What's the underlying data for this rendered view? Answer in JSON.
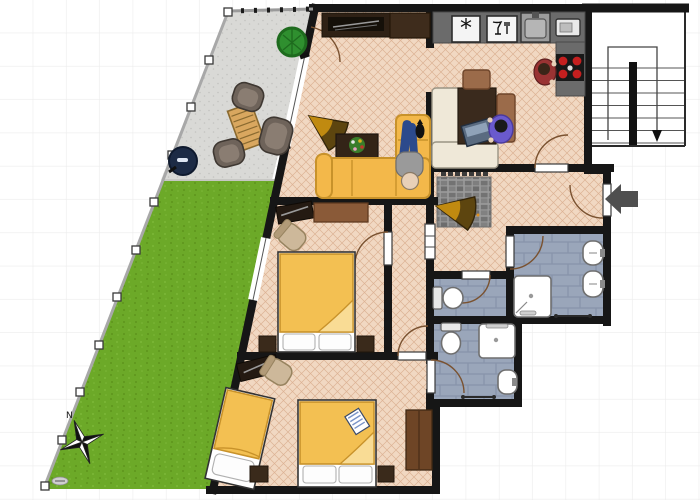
{
  "compass": {
    "north_label": "N"
  },
  "icons": {
    "fridge_glyph": "*"
  },
  "entrance": {
    "arrow_direction": "left"
  },
  "stairs": {
    "arrow_direction": "down",
    "treads": 7
  },
  "colors": {
    "grid": "#ececec",
    "wall": "#161616",
    "floor": "#f1d8c2",
    "floor_line": "#dcb294",
    "terrace": "#d9d9d6",
    "terrace_dot": "#c3c3c0",
    "lawn": "#6ca928",
    "lawn_dark": "#5e941c",
    "lawn_light": "#7cb838",
    "fence_line": "#a8a8a8",
    "tile": "#9aa6ba",
    "tile_line": "#8793aa",
    "mat": "#9b9b9b",
    "door_arc": "#7a5230",
    "wood_dark": "#3a2a1b",
    "wood": "#8a5a38",
    "wood_mid": "#6e4526",
    "wood_light": "#9b6b4a",
    "cream": "#efe8d8",
    "sofa": "#f3b84a",
    "sofa_line": "#c8922a",
    "duvet": "#f3c052",
    "duvet_light": "#f9dc95",
    "counter": "#6b6b6b",
    "stove": "#181818",
    "burner": "#c41f1f",
    "arrow": "#4f4f4f",
    "chair_tan": "#cdb89a",
    "fan_dark": "#5d450f",
    "fan_light": "#c08a10",
    "bush": "#2f8f2f",
    "bush_dark": "#1e6b1e",
    "grill": "#1d2b45",
    "person_purple": "#6a5acd",
    "person_jeans": "#2c4a8c",
    "person_gray": "#9a9a9a",
    "person_red": "#993333",
    "skin": "#e8d0b8"
  },
  "areas": {
    "garden": {
      "type": "lawn",
      "features": [
        "compass-rose",
        "fence"
      ]
    },
    "terrace": {
      "furniture": [
        "bush",
        "kettle-grill",
        "lounge-chair",
        "lounge-chair",
        "lounge-chair",
        "slatted-wood-table"
      ]
    },
    "living_room": {
      "furniture": [
        "tv-sideboard",
        "corner-cabinet",
        "fan-armchair",
        "coffee-table-with-flowers",
        "corner-sofa",
        "person-lying",
        "cat"
      ]
    },
    "kitchen_dining": {
      "furniture": [
        "counter",
        "fridge",
        "dishwasher",
        "kitchen-sink",
        "microwave",
        "stove",
        "dining-table",
        "wood-chair",
        "wood-chair",
        "corner-bench",
        "laptop",
        "person-cooking",
        "person-at-table"
      ]
    },
    "hallway": {
      "furniture": [
        "stone-doormat",
        "shoe-rack",
        "fan-armchair"
      ]
    },
    "bedroom_1": {
      "furniture": [
        "double-bed",
        "nightstand",
        "nightstand",
        "dresser",
        "tv-shelf",
        "chair"
      ]
    },
    "bedroom_2": {
      "furniture": [
        "double-bed",
        "single-bed",
        "nightstand",
        "nightstand",
        "wardrobe",
        "corner-tv-stand",
        "chair",
        "book"
      ]
    },
    "bathroom_main": {
      "fixtures": [
        "shower",
        "sink",
        "sink",
        "towel-rail"
      ]
    },
    "wc": {
      "fixtures": [
        "toilet"
      ]
    },
    "ensuite_bathroom": {
      "fixtures": [
        "toilet",
        "shower",
        "sink",
        "towel-rail"
      ]
    },
    "stairwell": {
      "features": [
        "u-stairs",
        "down-arrow"
      ]
    }
  }
}
